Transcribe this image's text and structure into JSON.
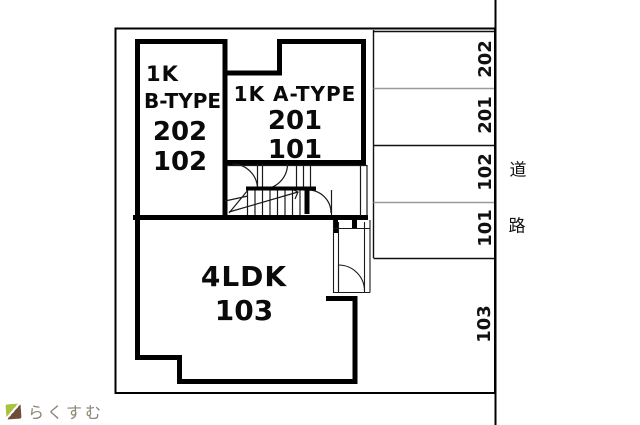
{
  "floorplan": {
    "units": {
      "b_type": {
        "size_label": "1K",
        "type_label": "B-TYPE",
        "room_upper": "202",
        "room_lower": "102"
      },
      "a_type": {
        "label": "1K A-TYPE",
        "room_upper": "201",
        "room_lower": "101"
      },
      "ldk": {
        "label": "4LDK",
        "room": "103"
      }
    },
    "parking": {
      "stalls": [
        "202",
        "201",
        "102",
        "101",
        "103"
      ]
    },
    "road": {
      "char1": "道",
      "char2": "路"
    },
    "logo": {
      "text": "らくすむ"
    }
  },
  "colors": {
    "wall": "#000000",
    "thin_line": "#1a1a1a",
    "gray_divider": "#9b9b9b",
    "logo_text": "#8d8473",
    "logo_green": "#a9c23f",
    "logo_brown": "#6f4e39"
  }
}
